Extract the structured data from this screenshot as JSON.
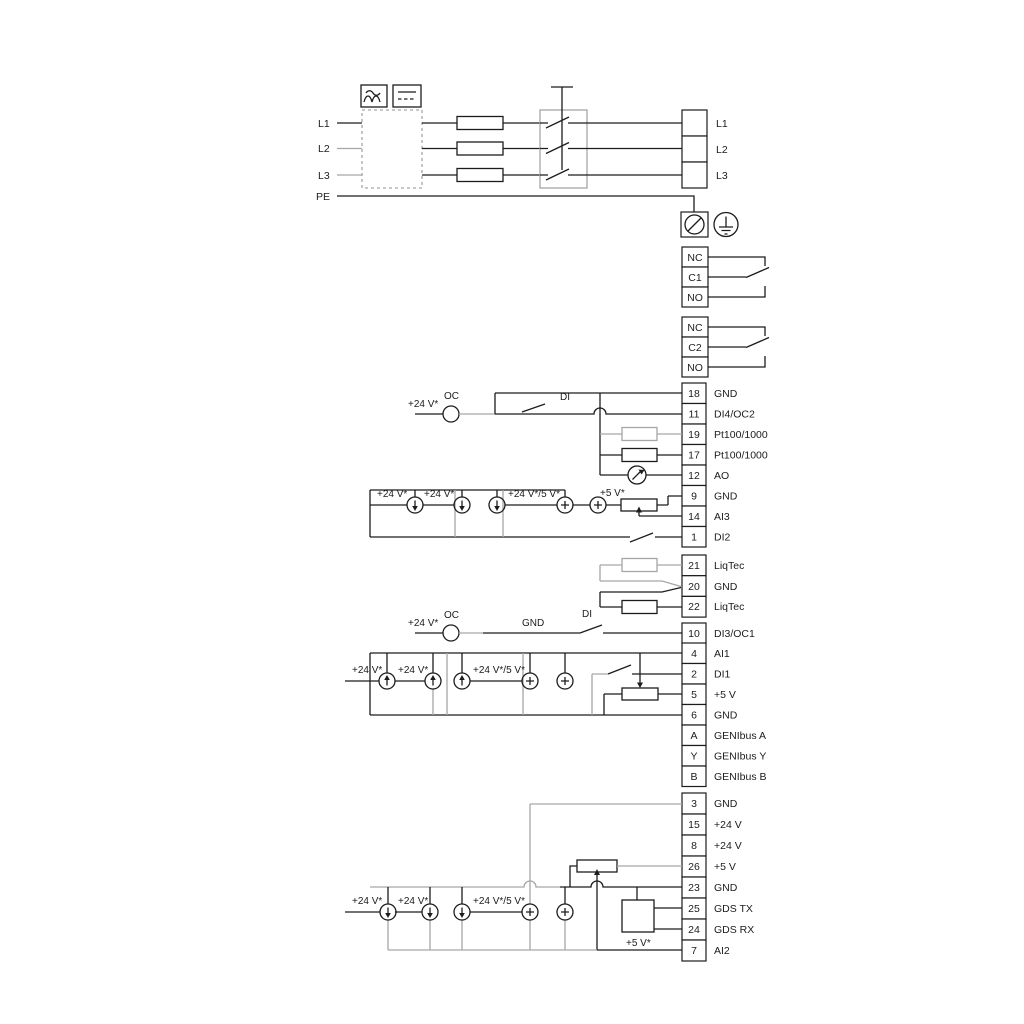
{
  "mains": {
    "l1": "L1",
    "l2": "L2",
    "l3": "L3",
    "pe": "PE"
  },
  "output": {
    "l1": "L1",
    "l2": "L2",
    "l3": "L3"
  },
  "relay1": {
    "nc": "NC",
    "c": "C1",
    "no": "NO"
  },
  "relay2": {
    "nc": "NC",
    "c": "C2",
    "no": "NO"
  },
  "strip1": {
    "rows": [
      {
        "num": "18",
        "label": "GND"
      },
      {
        "num": "11",
        "label": "DI4/OC2"
      },
      {
        "num": "19",
        "label": "Pt100/1000"
      },
      {
        "num": "17",
        "label": "Pt100/1000"
      },
      {
        "num": "12",
        "label": "AO"
      },
      {
        "num": "9",
        "label": "GND"
      },
      {
        "num": "14",
        "label": "AI3"
      },
      {
        "num": "1",
        "label": "DI2"
      }
    ]
  },
  "liqtec": {
    "rows": [
      {
        "num": "21",
        "label": "LiqTec"
      },
      {
        "num": "20",
        "label": "GND"
      },
      {
        "num": "22",
        "label": "LiqTec"
      }
    ]
  },
  "di3row": {
    "num": "10",
    "label": "DI3/OC1"
  },
  "strip3": {
    "rows": [
      {
        "num": "4",
        "label": "AI1"
      },
      {
        "num": "2",
        "label": "DI1"
      },
      {
        "num": "5",
        "label": "+5 V"
      },
      {
        "num": "6",
        "label": "GND"
      },
      {
        "num": "A",
        "label": "GENIbus A"
      },
      {
        "num": "Y",
        "label": "GENIbus Y"
      },
      {
        "num": "B",
        "label": "GENIbus B"
      }
    ]
  },
  "strip4": {
    "rows": [
      {
        "num": "3",
        "label": "GND"
      },
      {
        "num": "15",
        "label": "+24 V"
      },
      {
        "num": "8",
        "label": "+24 V"
      },
      {
        "num": "26",
        "label": "+5 V"
      },
      {
        "num": "23",
        "label": "GND"
      },
      {
        "num": "25",
        "label": "GDS TX"
      },
      {
        "num": "24",
        "label": "GDS RX"
      },
      {
        "num": "7",
        "label": "AI2"
      }
    ]
  },
  "ann": {
    "oc_top": {
      "v24": "+24 V*",
      "oc": "OC",
      "di": "DI"
    },
    "oc_mid": {
      "v24": "+24 V*",
      "oc": "OC",
      "gnd": "GND",
      "di": "DI"
    },
    "src_ai3": {
      "a": "+24 V*",
      "b": "+24 V*",
      "c": "+24 V*/5 V*",
      "d": "+5 V*"
    },
    "src_ai1": {
      "a": "+24 V*",
      "b": "+24 V*",
      "c": "+24 V*/5 V*"
    },
    "src_ai2": {
      "a": "+24 V*",
      "b": "+24 V*",
      "c": "+24 V*/5 V*",
      "d": "+5 V*"
    }
  }
}
